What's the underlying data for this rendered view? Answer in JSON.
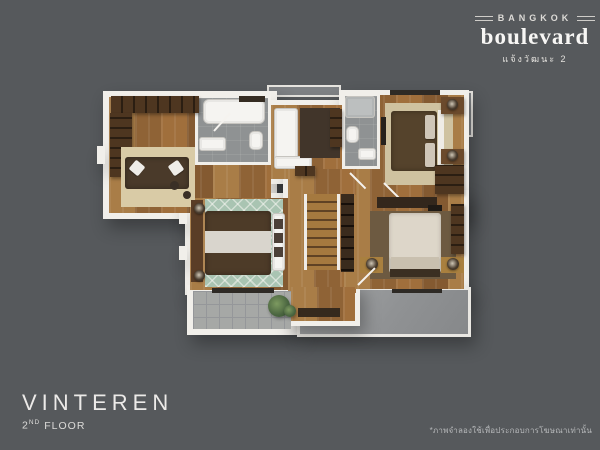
{
  "header": {
    "brand_top": "BANGKOK",
    "brand_main": "boulevard",
    "brand_sub": "แจ้งวัฒนะ 2"
  },
  "title": {
    "name": "VINTEREN",
    "floor_number": "2",
    "floor_suffix": "ND",
    "floor_word": "FLOOR"
  },
  "footer": {
    "disclaimer": "*ภาพจำลองใช้เพื่อประกอบการโฆษณาเท่านั้น"
  },
  "colors": {
    "background": "#56595c",
    "text_light": "#eceae7",
    "text_dim": "#b5b7b9",
    "wall_white": "#f1efea",
    "wood_floor": "#9d7140",
    "bath_gray": "#8f9293",
    "balcony_tile": "#a6a8a6",
    "terrace_gray": "#909294",
    "cabinet_brown": "#4e3620",
    "rug_teal": "#a9c4b2",
    "rug_beige": "#d9cba6",
    "bed_dark": "#4d3b28",
    "bed_light": "#ddd6c9",
    "plant_green": "#4a6540"
  },
  "floorplan": {
    "label": "VINTEREN 2nd floor plan rendering",
    "elements": [
      {
        "n": "ac-ledge-top",
        "c": "ledge",
        "x": 267,
        "y": 85,
        "w": 74,
        "h": 12
      },
      {
        "n": "ac-ledge-right",
        "c": "ledge",
        "x": 458,
        "y": 91,
        "w": 15,
        "h": 46
      },
      {
        "n": "wall-upper-left",
        "c": "wall",
        "x": 103,
        "y": 91,
        "w": 174,
        "h": 128
      },
      {
        "n": "wall-sitting-room",
        "c": "wall",
        "x": 266,
        "y": 100,
        "w": 82,
        "h": 84
      },
      {
        "n": "wall-upper-right",
        "c": "wall",
        "x": 339,
        "y": 90,
        "w": 130,
        "h": 130
      },
      {
        "n": "wall-bedroom3",
        "c": "wall",
        "x": 185,
        "y": 193,
        "w": 114,
        "h": 102
      },
      {
        "n": "wall-hall",
        "c": "wall",
        "x": 283,
        "y": 164,
        "w": 78,
        "h": 134
      },
      {
        "n": "wall-master",
        "c": "wall",
        "x": 339,
        "y": 190,
        "w": 130,
        "h": 104
      },
      {
        "n": "wall-tab-left",
        "c": "wall",
        "x": 97,
        "y": 146,
        "w": 8,
        "h": 18
      },
      {
        "n": "wall-tab-bedroom3-a",
        "c": "wall",
        "x": 179,
        "y": 210,
        "w": 8,
        "h": 14
      },
      {
        "n": "wall-tab-bedroom3-b",
        "c": "wall",
        "x": 179,
        "y": 246,
        "w": 8,
        "h": 14
      },
      {
        "n": "balcony-frame",
        "c": "wall",
        "x": 187,
        "y": 285,
        "w": 110,
        "h": 50
      },
      {
        "n": "roof-terrace",
        "c": "terr",
        "x": 297,
        "y": 287,
        "w": 174,
        "h": 50
      },
      {
        "n": "wall-stairwell",
        "c": "wall",
        "x": 286,
        "y": 282,
        "w": 74,
        "h": 44
      },
      {
        "n": "floor-walkin-closet",
        "c": "wood",
        "x": 109,
        "y": 97,
        "w": 162,
        "h": 116
      },
      {
        "n": "floor-bathroom1",
        "c": "bath bwall",
        "x": 195,
        "y": 95,
        "w": 76,
        "h": 70
      },
      {
        "n": "floor-sitting-room",
        "c": "wood",
        "x": 271,
        "y": 105,
        "w": 72,
        "h": 74
      },
      {
        "n": "floor-bedroom2",
        "c": "wood",
        "x": 344,
        "y": 95,
        "w": 120,
        "h": 120
      },
      {
        "n": "floor-bathroom2",
        "c": "bath bwall",
        "x": 342,
        "y": 93,
        "w": 38,
        "h": 76
      },
      {
        "n": "floor-bedroom3",
        "c": "wood",
        "x": 190,
        "y": 198,
        "w": 104,
        "h": 92
      },
      {
        "n": "floor-hall",
        "c": "wood",
        "x": 288,
        "y": 169,
        "w": 68,
        "h": 124
      },
      {
        "n": "floor-master-bedroom",
        "c": "wood",
        "x": 344,
        "y": 195,
        "w": 120,
        "h": 94
      },
      {
        "n": "floor-stairwell",
        "c": "wood",
        "x": 291,
        "y": 287,
        "w": 64,
        "h": 34
      },
      {
        "n": "floor-balcony",
        "c": "tile",
        "x": 193,
        "y": 291,
        "w": 98,
        "h": 38
      },
      {
        "n": "walkin-wardrobe-top",
        "c": "cab svv",
        "x": 111,
        "y": 96,
        "w": 88,
        "h": 17
      },
      {
        "n": "walkin-wardrobe-left",
        "c": "cab shv",
        "x": 110,
        "y": 113,
        "w": 22,
        "h": 64
      },
      {
        "n": "walkin-rug",
        "c": "",
        "x": 121,
        "y": 147,
        "w": 74,
        "h": 60,
        "f": "#d9cba6"
      },
      {
        "n": "walkin-sofa",
        "c": "bedd",
        "x": 125,
        "y": 157,
        "w": 64,
        "h": 32,
        "f": "#4a3a2a"
      },
      {
        "n": "walkin-pillow-1",
        "c": "pillow",
        "x": 131,
        "y": 162,
        "w": 12,
        "h": 12,
        "r": 40
      },
      {
        "n": "walkin-pillow-2",
        "c": "pillow",
        "x": 170,
        "y": 162,
        "w": 12,
        "h": 12,
        "r": -35
      },
      {
        "n": "walkin-stool-1",
        "c": "round",
        "x": 170,
        "y": 181,
        "w": 9,
        "h": 9,
        "f": "#3a2f26"
      },
      {
        "n": "walkin-stool-2",
        "c": "round",
        "x": 183,
        "y": 191,
        "w": 8,
        "h": 8,
        "f": "#3a2f26"
      },
      {
        "n": "bathtub",
        "c": "fixture",
        "x": 203,
        "y": 99,
        "w": 62,
        "h": 25,
        "br": 6
      },
      {
        "n": "bath1-counter",
        "c": "",
        "x": 239,
        "y": 96,
        "w": 26,
        "h": 6,
        "f": "#352c22"
      },
      {
        "n": "bath1-vanity",
        "c": "fixture",
        "x": 199,
        "y": 137,
        "w": 27,
        "h": 14
      },
      {
        "n": "bath1-toilet",
        "c": "fixture",
        "x": 249,
        "y": 131,
        "w": 14,
        "h": 19,
        "br": 5
      },
      {
        "n": "bath1-door-swing",
        "c": "line",
        "x": 214,
        "y": 130,
        "w": 24,
        "h": 2,
        "r": -48
      },
      {
        "n": "sitting-sofa",
        "c": "fixture",
        "x": 274,
        "y": 108,
        "w": 24,
        "h": 60
      },
      {
        "n": "sitting-sofa-foot",
        "c": "fixture",
        "x": 274,
        "y": 156,
        "w": 38,
        "h": 13
      },
      {
        "n": "sitting-rug",
        "c": "",
        "x": 300,
        "y": 108,
        "w": 40,
        "h": 50,
        "f": "#41352a"
      },
      {
        "n": "sitting-sideboard",
        "c": "cab shv",
        "x": 330,
        "y": 109,
        "w": 12,
        "h": 38
      },
      {
        "n": "shower",
        "c": "fixture",
        "x": 345,
        "y": 96,
        "w": 30,
        "h": 22,
        "f": "#bcbfbf"
      },
      {
        "n": "bath2-toilet",
        "c": "fixture",
        "x": 346,
        "y": 126,
        "w": 13,
        "h": 17,
        "br": 5
      },
      {
        "n": "bath2-vanity",
        "c": "fixture",
        "x": 358,
        "y": 148,
        "w": 18,
        "h": 12
      },
      {
        "n": "bath2-door-swing",
        "c": "line",
        "x": 350,
        "y": 172,
        "w": 22,
        "h": 2,
        "r": 45
      },
      {
        "n": "bedroom2-window",
        "c": "",
        "x": 390,
        "y": 90,
        "w": 50,
        "h": 5,
        "f": "#2e2a25"
      },
      {
        "n": "bedroom2-rug",
        "c": "",
        "x": 385,
        "y": 103,
        "w": 68,
        "h": 82,
        "f": "#cfc2a0"
      },
      {
        "n": "bedroom2-bed",
        "c": "bedd",
        "x": 391,
        "y": 111,
        "w": 46,
        "h": 60,
        "f": "#55432c"
      },
      {
        "n": "bedroom2-pillow-1",
        "c": "pillow",
        "x": 425,
        "y": 115,
        "w": 10,
        "h": 24,
        "f": "#cfc6b8"
      },
      {
        "n": "bedroom2-pillow-2",
        "c": "pillow",
        "x": 425,
        "y": 143,
        "w": 10,
        "h": 24,
        "f": "#cfc6b8"
      },
      {
        "n": "bedroom2-headboard",
        "c": "",
        "x": 438,
        "y": 110,
        "w": 6,
        "h": 62,
        "f": "#efece6"
      },
      {
        "n": "bedroom2-nightstand-1",
        "c": "cab",
        "x": 441,
        "y": 97,
        "w": 23,
        "h": 17,
        "f": "#6b4a2c"
      },
      {
        "n": "bedroom2-lamp-1",
        "c": "lamp",
        "x": 447,
        "y": 99,
        "w": 11,
        "h": 11
      },
      {
        "n": "bedroom2-nightstand-2",
        "c": "cab",
        "x": 441,
        "y": 149,
        "w": 23,
        "h": 15,
        "f": "#6b4a2c"
      },
      {
        "n": "bedroom2-lamp-2",
        "c": "lamp",
        "x": 447,
        "y": 150,
        "w": 11,
        "h": 11
      },
      {
        "n": "bedroom2-wardrobe",
        "c": "cab shv",
        "x": 435,
        "y": 165,
        "w": 29,
        "h": 29
      },
      {
        "n": "bedroom2-tv-panel",
        "c": "",
        "x": 381,
        "y": 117,
        "w": 5,
        "h": 28,
        "f": "#26211c"
      },
      {
        "n": "bedroom2-door-swing",
        "c": "line",
        "x": 384,
        "y": 182,
        "w": 22,
        "h": 2,
        "r": 45
      },
      {
        "n": "bedroom3-headboard-panel",
        "c": "",
        "x": 191,
        "y": 200,
        "w": 12,
        "h": 82,
        "f": "#5a3d26"
      },
      {
        "n": "bedroom3-rug",
        "c": "rug-teal",
        "x": 205,
        "y": 199,
        "w": 78,
        "h": 88
      },
      {
        "n": "bedroom3-bed",
        "c": "bedd",
        "x": 205,
        "y": 211,
        "w": 66,
        "h": 64,
        "f": "#4d3b28"
      },
      {
        "n": "bedroom3-bed-runner",
        "c": "",
        "x": 205,
        "y": 231,
        "w": 66,
        "h": 22,
        "f": "#d9d5cd"
      },
      {
        "n": "bedroom3-lamp-1",
        "c": "lamp",
        "x": 194,
        "y": 203,
        "w": 11,
        "h": 11
      },
      {
        "n": "bedroom3-lamp-2",
        "c": "lamp",
        "x": 194,
        "y": 270,
        "w": 11,
        "h": 11
      },
      {
        "n": "bedroom3-bench",
        "c": "fixture",
        "x": 272,
        "y": 213,
        "w": 13,
        "h": 58
      },
      {
        "n": "bedroom3-bench-pillow-1",
        "c": "",
        "x": 274,
        "y": 219,
        "w": 9,
        "h": 10,
        "f": "#4c4038"
      },
      {
        "n": "bedroom3-bench-pillow-2",
        "c": "",
        "x": 274,
        "y": 233,
        "w": 9,
        "h": 10,
        "f": "#4c4038"
      },
      {
        "n": "bedroom3-bench-pillow-3",
        "c": "",
        "x": 274,
        "y": 247,
        "w": 9,
        "h": 10,
        "f": "#4c4038"
      },
      {
        "n": "bedroom3-window",
        "c": "",
        "x": 212,
        "y": 288,
        "w": 62,
        "h": 5,
        "f": "#2e2a25"
      },
      {
        "n": "hall-closet",
        "c": "cab svv",
        "x": 295,
        "y": 166,
        "w": 20,
        "h": 10
      },
      {
        "n": "staircase",
        "c": "stairs",
        "x": 304,
        "y": 194,
        "w": 36,
        "h": 76
      },
      {
        "n": "stair-shelf-column",
        "c": "shelf-col",
        "x": 341,
        "y": 194,
        "w": 13,
        "h": 78
      },
      {
        "n": "stair-landing-mat",
        "c": "",
        "x": 298,
        "y": 308,
        "w": 42,
        "h": 9,
        "f": "#35291d"
      },
      {
        "n": "master-dresser",
        "c": "",
        "x": 377,
        "y": 197,
        "w": 60,
        "h": 11,
        "f": "#33271c"
      },
      {
        "n": "master-dresser-deco",
        "c": "",
        "x": 428,
        "y": 205,
        "w": 14,
        "h": 7,
        "f": "#1f1a15"
      },
      {
        "n": "master-rug",
        "c": "",
        "x": 370,
        "y": 211,
        "w": 86,
        "h": 68,
        "f": "#6d5a41"
      },
      {
        "n": "master-bed",
        "c": "bedl",
        "x": 389,
        "y": 213,
        "w": 52,
        "h": 60,
        "f": "#ddd6c9"
      },
      {
        "n": "master-bed-pillows",
        "c": "",
        "x": 391,
        "y": 257,
        "w": 48,
        "h": 12,
        "f": "#c9c0af"
      },
      {
        "n": "master-headboard",
        "c": "",
        "x": 390,
        "y": 269,
        "w": 50,
        "h": 8,
        "f": "#3b2f22"
      },
      {
        "n": "master-nightstand-1",
        "c": "",
        "x": 360,
        "y": 257,
        "w": 23,
        "h": 16,
        "f": "#a9803f"
      },
      {
        "n": "master-lamp-1",
        "c": "lamp",
        "x": 366,
        "y": 258,
        "w": 12,
        "h": 12
      },
      {
        "n": "master-nightstand-2",
        "c": "",
        "x": 441,
        "y": 257,
        "w": 23,
        "h": 16,
        "f": "#a9803f"
      },
      {
        "n": "master-lamp-2",
        "c": "lamp",
        "x": 447,
        "y": 258,
        "w": 12,
        "h": 12
      },
      {
        "n": "master-wardrobe",
        "c": "cab shv",
        "x": 451,
        "y": 204,
        "w": 13,
        "h": 50
      },
      {
        "n": "master-window",
        "c": "",
        "x": 392,
        "y": 289,
        "w": 50,
        "h": 4,
        "f": "#2e2a25"
      },
      {
        "n": "master-door-swing",
        "c": "line",
        "x": 358,
        "y": 284,
        "w": 24,
        "h": 2,
        "r": -45
      },
      {
        "n": "balcony-plant",
        "c": "plant",
        "x": 268,
        "y": 295,
        "w": 22,
        "h": 22
      },
      {
        "n": "balcony-plant-small",
        "c": "plant",
        "x": 284,
        "y": 305,
        "w": 12,
        "h": 12
      }
    ]
  }
}
